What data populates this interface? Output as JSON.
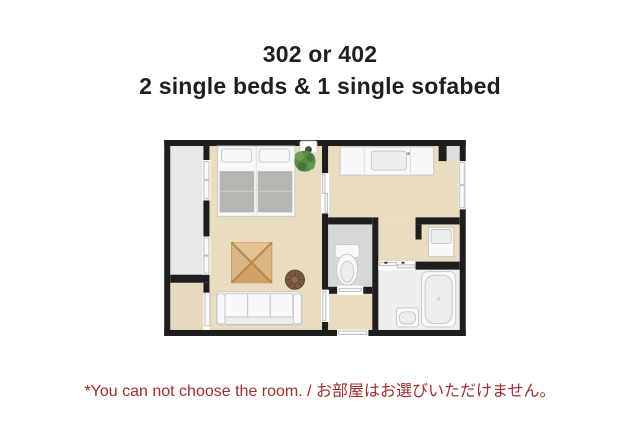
{
  "header": {
    "line1": "302 or 402",
    "line2": "2 single beds & 1 single sofabed"
  },
  "note": {
    "text": "*You can not choose the room. / お部屋はお選びいただけません。"
  },
  "colors": {
    "wall": "#1e1e1c",
    "floor_wood": "#e9dcc0",
    "floor_balcony": "#e8e8e8",
    "floor_closet": "#e6d9c0",
    "floor_toilet": "#d7d7d7",
    "floor_bath": "#efefef",
    "blanket_gray": "#b6b5b1",
    "table_wood": "#d9b585",
    "pouf_brown": "#7c5a41",
    "plant_green": "#5a8a46",
    "corner_notch_gray": "#dedede",
    "title_text": "#1f1f1f",
    "note_text": "#a02e2e"
  },
  "floorplan": {
    "kind": "hotel room floor plan, top-down view",
    "rooms": [
      "balcony",
      "bedroom-living-room",
      "closet",
      "kitchen-dining-room",
      "toilet-room",
      "entry-corridor",
      "washbasin-niche",
      "bathroom"
    ],
    "furniture": [
      "single-bed-1",
      "single-bed-2",
      "plant",
      "low-table",
      "pouf",
      "sofa-bed",
      "kitchen-counter",
      "kitchen-sink",
      "toilet",
      "washbasin-cabinet",
      "bathtub",
      "bathroom-sink",
      "ceiling-fixture"
    ]
  }
}
